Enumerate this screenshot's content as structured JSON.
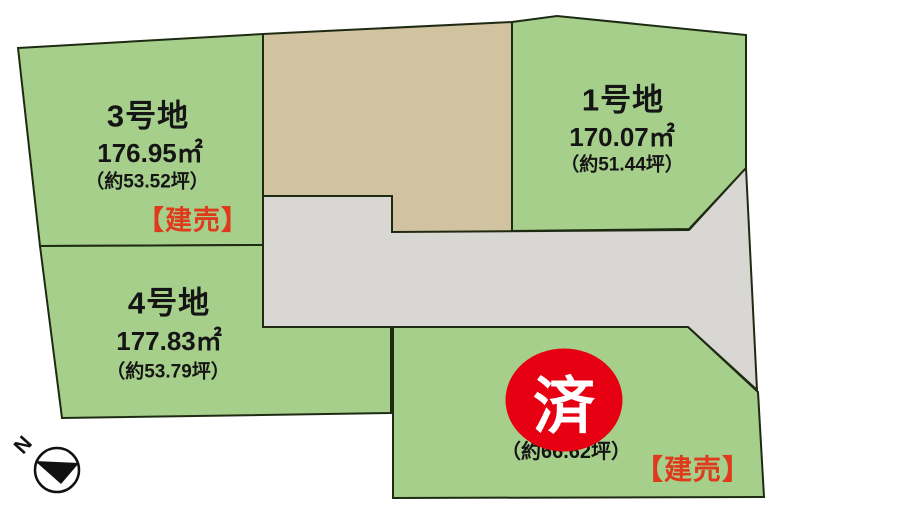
{
  "map": {
    "plots": [
      {
        "id": "3",
        "name": "3号地",
        "area_m2": "176.95㎡",
        "area_tsubo": "（約53.52坪）",
        "sale_label": "【建売】"
      },
      {
        "id": "1",
        "name": "1号地",
        "area_m2": "170.07㎡",
        "area_tsubo": "（約51.44坪）"
      },
      {
        "id": "4",
        "name": "4号地",
        "area_m2": "177.83㎡",
        "area_tsubo": "（約53.79坪）"
      },
      {
        "id": "2",
        "area_tsubo": "（約66.62坪）",
        "sold_badge": "済",
        "sale_label": "【建売】"
      }
    ],
    "compass_label": "N",
    "colors": {
      "lot_green": "#a6cf8b",
      "reserved_tan": "#d2c3a0",
      "road_gray": "#d8d7d4",
      "outline": "#1e2b12",
      "sale_red": "#e03a1c",
      "sold_badge_red": "#e60012",
      "sold_badge_text": "#ffffff",
      "label_text": "#151515",
      "background": "#ffffff"
    }
  }
}
